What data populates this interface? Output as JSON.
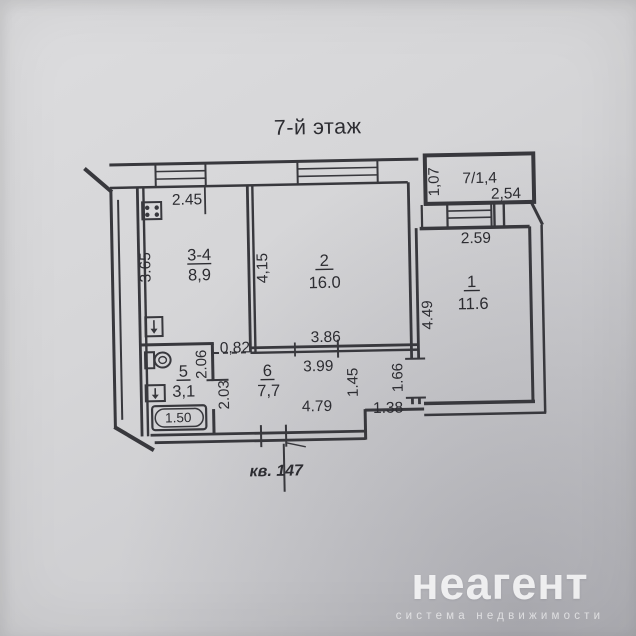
{
  "photo": {
    "floor_title": "7-й этаж",
    "apartment_label": "кв. 147"
  },
  "rooms": {
    "kitchen": {
      "number": "3-4",
      "area": "8,9"
    },
    "living": {
      "number": "2",
      "area": "16.0"
    },
    "bedroom": {
      "number": "1",
      "area": "11.6"
    },
    "bathroom": {
      "number": "5",
      "area": "3,1"
    },
    "hall": {
      "number": "6",
      "area": "7,7"
    },
    "balcony": {
      "label": "7/1,4"
    }
  },
  "dims": {
    "kitchen_width": "2.45",
    "kitchen_depth": "3.65",
    "living_depth": "4,15",
    "living_width": "3.86",
    "hall_top_width": "3.99",
    "hall_bottom_width": "4.79",
    "hall_seg1": "1.45",
    "hall_seg2": "1.66",
    "entry_niche": "1.38",
    "kitchen_opening": "0,82",
    "bath_depth1": "2.06",
    "bath_depth2": "2.03",
    "bathtub_length": "1.50",
    "bedroom_width": "2.59",
    "bedroom_depth": "4.49",
    "balcony_depth": "1,07",
    "balcony_width": "2,54"
  },
  "watermark": {
    "brand": "неагент",
    "tagline": "система недвижимости"
  },
  "colors": {
    "paper": "#d3d3d5",
    "ink": "#38383d",
    "watermark": "#ffffff"
  }
}
